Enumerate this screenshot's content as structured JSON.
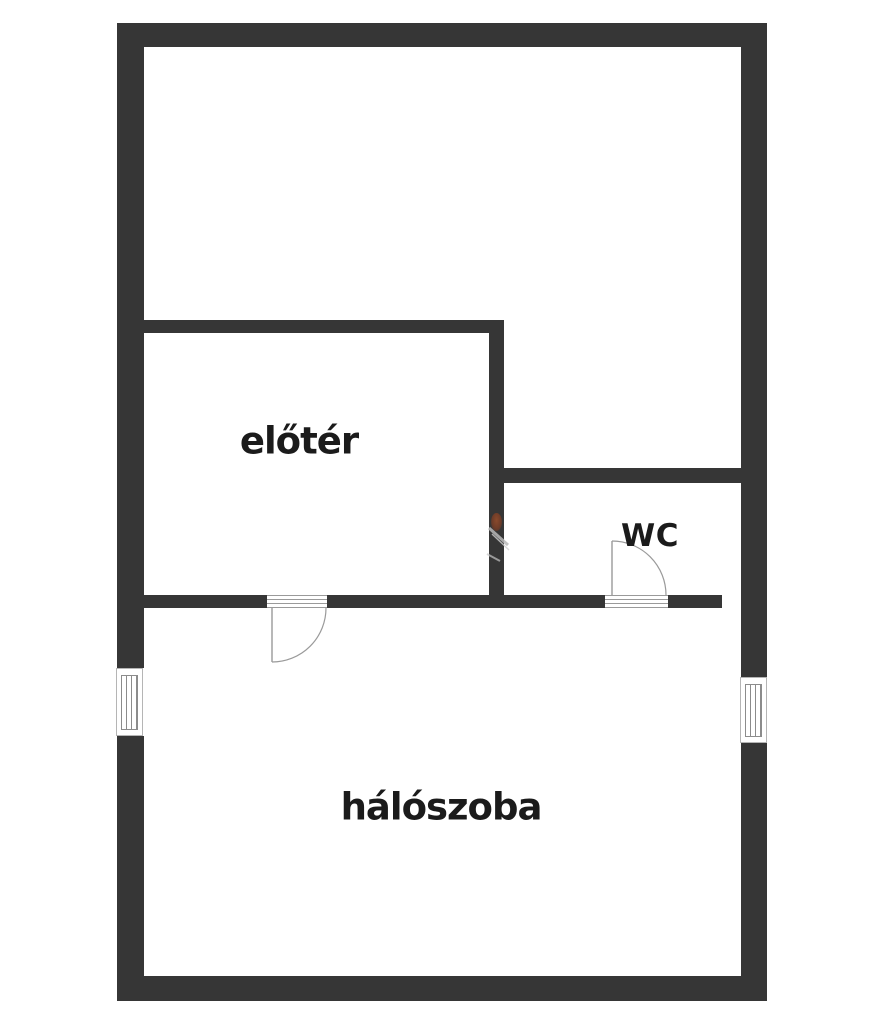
{
  "document": {
    "type": "floor-plan"
  },
  "rooms": {
    "upper_room": {
      "label": ""
    },
    "entry_hall": {
      "label": "előtér"
    },
    "wc": {
      "label": "WC"
    },
    "bedroom": {
      "label": "hálószoba"
    }
  },
  "doors": [
    {
      "name": "entry-hall-to-bedroom-door"
    },
    {
      "name": "wc-door"
    }
  ],
  "windows": [
    {
      "name": "bedroom-window-left"
    },
    {
      "name": "bedroom-window-right"
    }
  ],
  "colors": {
    "wall": "#363636",
    "background": "#ffffff",
    "room_label": "#1b1b1b",
    "door_line": "#9a9a9a",
    "window_frame": "#b5b5b5",
    "artifact_accent": "#8a4a2c"
  }
}
